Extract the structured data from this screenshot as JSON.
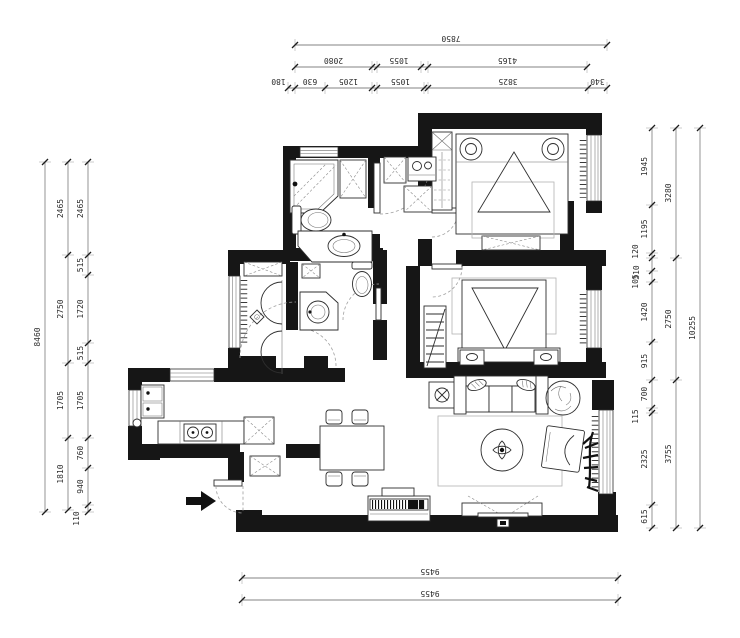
{
  "title": "apartment-floor-plan",
  "colors": {
    "wall": "#161616",
    "furniture_line": "#2e2e2e",
    "dimension_line": "#5a5a5a",
    "dimension_text": "#2c2c2c",
    "dashed_door": "#9f9f9f",
    "background": "#ffffff"
  },
  "symbols": [
    "entry-arrow",
    "entry-door",
    "master-bed",
    "wardrobe",
    "tv-dresser",
    "second-bed",
    "nightstand",
    "clothes-rack",
    "shower",
    "toilet",
    "vanity-sink",
    "washing-machine",
    "hanging-closet",
    "floor-drain",
    "kitchen-sink",
    "stove",
    "fridge",
    "dining-table",
    "dining-chair",
    "sofa",
    "side-table",
    "plant",
    "rug",
    "coffee-table",
    "armchair",
    "tv-cabinet",
    "piano",
    "window",
    "curtain"
  ],
  "dimensions": {
    "top": [
      {
        "pos": 45,
        "segs": [
          {
            "a": 295,
            "b": 607,
            "t": "7850"
          }
        ]
      },
      {
        "pos": 67,
        "segs": [
          {
            "a": 295,
            "b": 372,
            "t": "2080"
          },
          {
            "a": 372,
            "b": 377
          },
          {
            "a": 377,
            "b": 421,
            "t": "1055"
          },
          {
            "a": 421,
            "b": 428
          },
          {
            "a": 428,
            "b": 587,
            "t": "4165"
          }
        ]
      },
      {
        "pos": 88,
        "segs": [
          {
            "a": 288,
            "b": 295,
            "t": "180",
            "ox": -13
          },
          {
            "a": 295,
            "b": 325,
            "t": "630"
          },
          {
            "a": 325,
            "b": 372,
            "t": "1205"
          },
          {
            "a": 372,
            "b": 377
          },
          {
            "a": 377,
            "b": 424,
            "t": "1055"
          },
          {
            "a": 424,
            "b": 428
          },
          {
            "a": 428,
            "b": 588,
            "t": "3825"
          },
          {
            "a": 588,
            "b": 607,
            "t": "340"
          }
        ]
      }
    ],
    "bottom": [
      {
        "pos": 578,
        "segs": [
          {
            "a": 242,
            "b": 618,
            "t": "9455"
          }
        ]
      },
      {
        "pos": 600,
        "segs": [
          {
            "a": 242,
            "b": 618,
            "t": "9455"
          }
        ]
      }
    ],
    "left": [
      {
        "pos": 45,
        "segs": [
          {
            "a": 162,
            "b": 512,
            "t": "8460"
          }
        ]
      },
      {
        "pos": 68,
        "segs": [
          {
            "a": 162,
            "b": 255,
            "t": "2465"
          },
          {
            "a": 255,
            "b": 363,
            "t": "2750"
          },
          {
            "a": 363,
            "b": 438,
            "t": "1705"
          },
          {
            "a": 438,
            "b": 510,
            "t": "1810"
          }
        ]
      },
      {
        "pos": 88,
        "segs": [
          {
            "a": 162,
            "b": 255,
            "t": "2465"
          },
          {
            "a": 255,
            "b": 275,
            "t": "515"
          },
          {
            "a": 275,
            "b": 343,
            "t": "1720"
          },
          {
            "a": 343,
            "b": 363,
            "t": "515"
          },
          {
            "a": 363,
            "b": 438,
            "t": "1705"
          },
          {
            "a": 438,
            "b": 468,
            "t": "760"
          },
          {
            "a": 468,
            "b": 505,
            "t": "940"
          },
          {
            "a": 505,
            "b": 512,
            "t": "110",
            "ox": -4,
            "oy": 10
          }
        ]
      }
    ],
    "right": [
      {
        "pos": 652,
        "segs": [
          {
            "a": 128,
            "b": 205,
            "t": "1945"
          },
          {
            "a": 205,
            "b": 253,
            "t": "1195"
          },
          {
            "a": 253,
            "b": 258,
            "t": "120",
            "ox": -9,
            "oy": -4
          },
          {
            "a": 258,
            "b": 271,
            "t": "310",
            "ox": -8,
            "oy": 8
          },
          {
            "a": 271,
            "b": 282,
            "t": "105",
            "ox": -9,
            "oy": 5
          },
          {
            "a": 282,
            "b": 342,
            "t": "1420"
          },
          {
            "a": 342,
            "b": 380,
            "t": "915"
          },
          {
            "a": 380,
            "b": 408,
            "t": "700"
          },
          {
            "a": 408,
            "b": 413,
            "t": "115",
            "ox": -9,
            "oy": 6
          },
          {
            "a": 413,
            "b": 505,
            "t": "2325"
          },
          {
            "a": 505,
            "b": 528,
            "t": "615"
          }
        ]
      },
      {
        "pos": 676,
        "segs": [
          {
            "a": 128,
            "b": 258,
            "t": "3280"
          },
          {
            "a": 258,
            "b": 380,
            "t": "2750"
          },
          {
            "a": 380,
            "b": 528,
            "t": "3755"
          }
        ]
      },
      {
        "pos": 700,
        "segs": [
          {
            "a": 128,
            "b": 528,
            "t": "10255"
          }
        ]
      }
    ]
  }
}
